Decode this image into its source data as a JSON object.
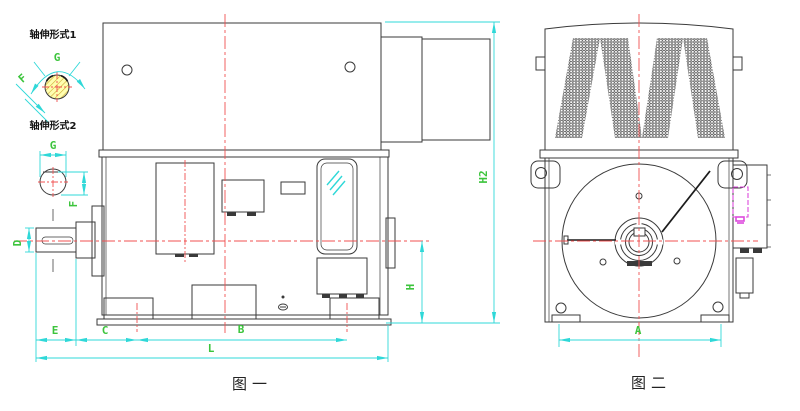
{
  "colors": {
    "line": "#3a3a3a",
    "centerline": "#f05050",
    "dim": "#2fd8d8",
    "label": "#3cc43c",
    "magenta": "#dd4add",
    "hatch_fill": "#ffffb0"
  },
  "shaft_forms": {
    "type1": {
      "title": "轴伸形式1",
      "g": "G",
      "f": "F"
    },
    "type2": {
      "title": "轴伸形式2",
      "g": "G",
      "f": "F"
    }
  },
  "figure1": {
    "caption": "图一",
    "dim_d": "D",
    "dim_e": "E",
    "dim_c": "C",
    "dim_b": "B",
    "dim_l": "L",
    "dim_h": "H",
    "dim_h2": "H2"
  },
  "figure2": {
    "caption": "图二",
    "dim_a": "A"
  }
}
